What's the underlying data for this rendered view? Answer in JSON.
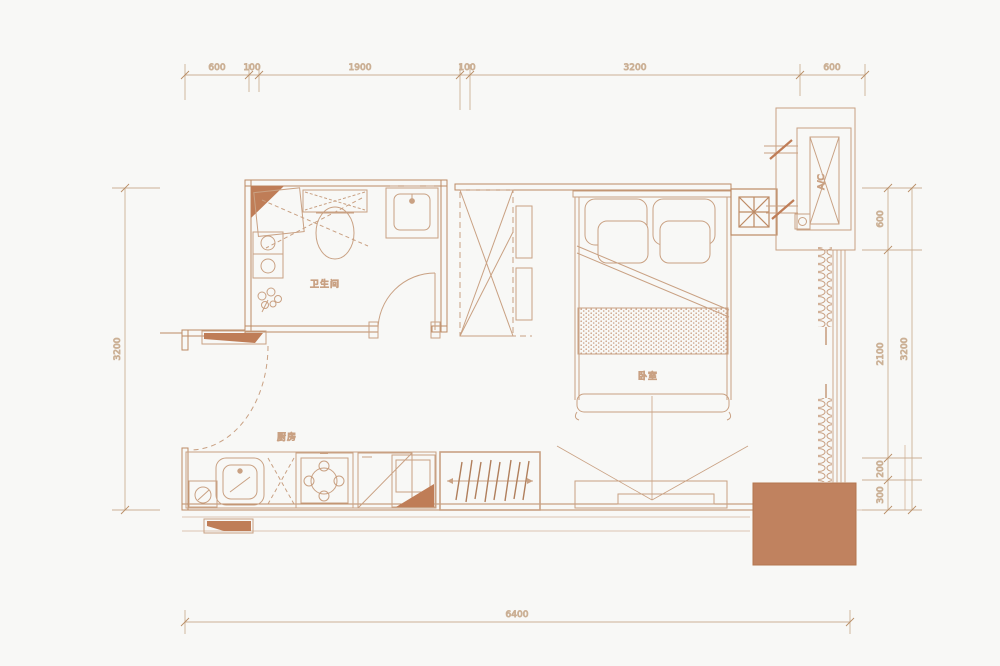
{
  "page": {
    "background": "#f8f8f6"
  },
  "plan": {
    "rooms": {
      "bathroom": "卫生间",
      "bedroom": "卧室",
      "kitchen": "厨房"
    },
    "equipment": {
      "ac": "A/C"
    },
    "colors": {
      "line": "#c9a183",
      "wall": "#bd8a64",
      "accent_fill": "#bf7d57",
      "terrace_fill": "#c0825f",
      "dim_line": "#cbb095",
      "dim_text": "#c49d7a"
    },
    "dimensions": {
      "top": [
        "600",
        "100",
        "1900",
        "100",
        "3200",
        "600"
      ],
      "left": [
        "3200"
      ],
      "right_inner": [
        "600",
        "2100",
        "200",
        "300"
      ],
      "right_outer": [
        "3200"
      ],
      "bottom": [
        "6400"
      ]
    }
  }
}
